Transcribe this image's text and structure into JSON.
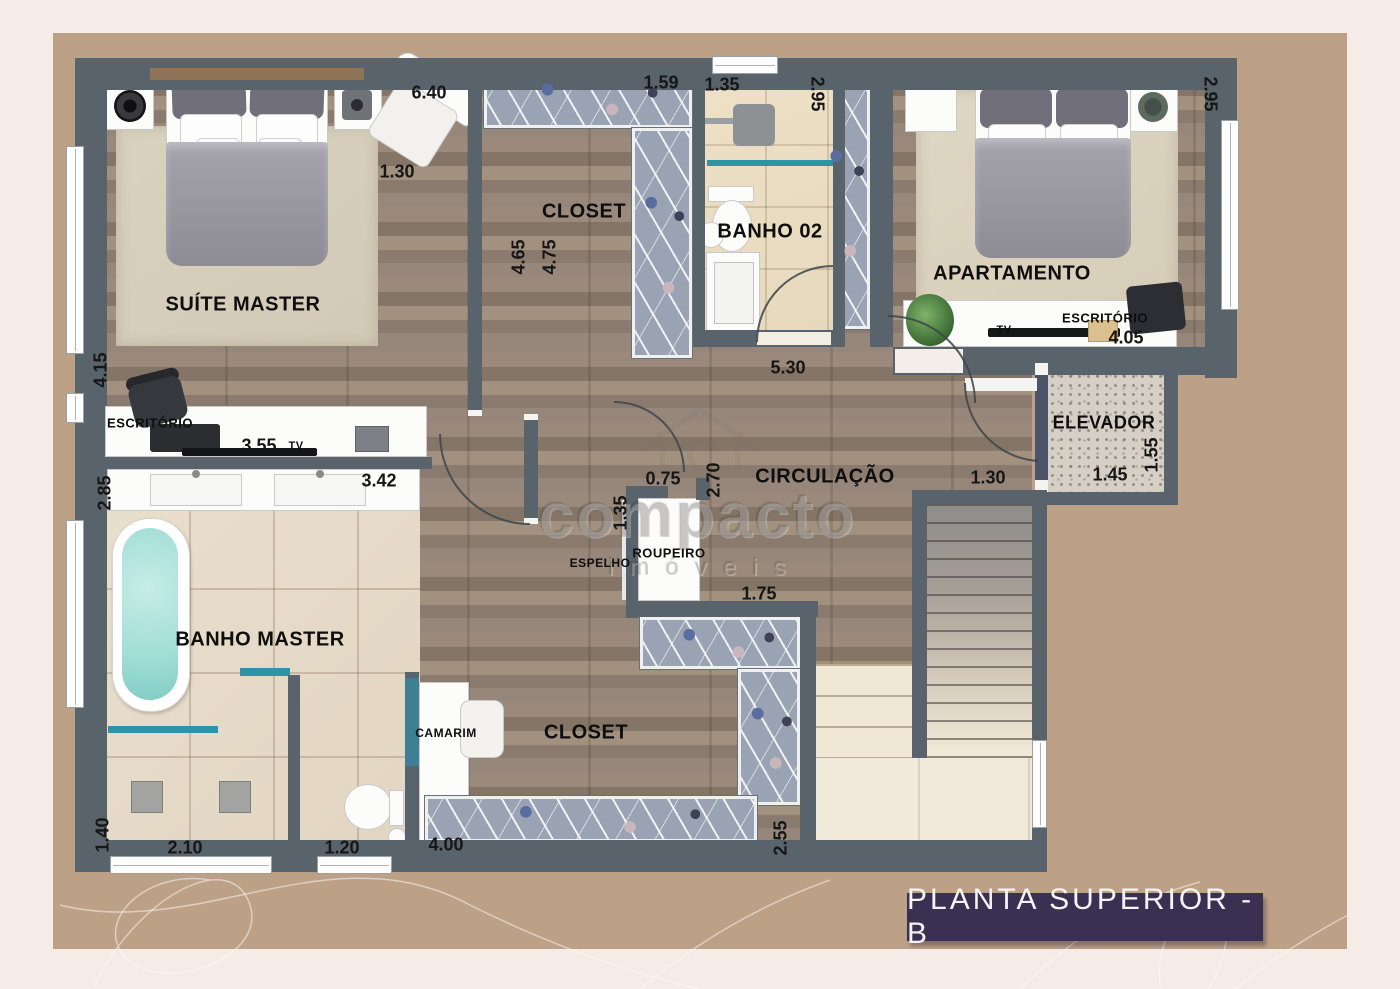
{
  "title": "PLANTA SUPERIOR - B",
  "watermark": {
    "brand": "compacto",
    "sub": "imóveis"
  },
  "rooms": {
    "suite": "SUÍTE MASTER",
    "closetTop": "CLOSET",
    "banho02": "BANHO 02",
    "apartamento": "APARTAMENTO",
    "aptoEscritorio": "ESCRITÓRIO",
    "aptoTv": "TV",
    "elevador": "ELEVADOR",
    "circulacao": "CIRCULAÇÃO",
    "roupeiro": "ROUPEIRO",
    "espelho": "ESPELHO",
    "suiteEscritorio": "ESCRITÓRIO",
    "suiteTv": "TV",
    "banhoMaster": "BANHO MASTER",
    "camarim": "CAMARIM",
    "closetLower": "CLOSET"
  },
  "dimensions": {
    "suiteWidth": "6.40",
    "suiteChair": "1.30",
    "suiteDepth": "4.15",
    "closetTopDoor": "1.59",
    "closetLen1": "4.65",
    "closetLen2": "4.75",
    "banho02Width": "1.35",
    "banho02Depth": "2.95",
    "aptoDepth": "2.95",
    "aptoWidth": "4.05",
    "circWidth": "5.30",
    "elevWidth": "1.45",
    "elevDepth": "1.55",
    "stairDoor": "1.30",
    "roupDoor": "0.75",
    "circDepth": "2.70",
    "roupDepth": "1.35",
    "roupWidth": "1.75",
    "tvWidth": "3.55",
    "banhoDepth": "2.85",
    "banhoWidth": "3.42",
    "showerDepth": "1.40",
    "showerWidth": "2.10",
    "wcWidth": "1.20",
    "closet2Width": "4.00",
    "closet2Depth": "2.55"
  },
  "colors": {
    "wall": "#59636b",
    "background": "#f6ece7",
    "mat": "#bda187",
    "banner": "#3a3052",
    "accentTeal": "#2f93a8"
  }
}
